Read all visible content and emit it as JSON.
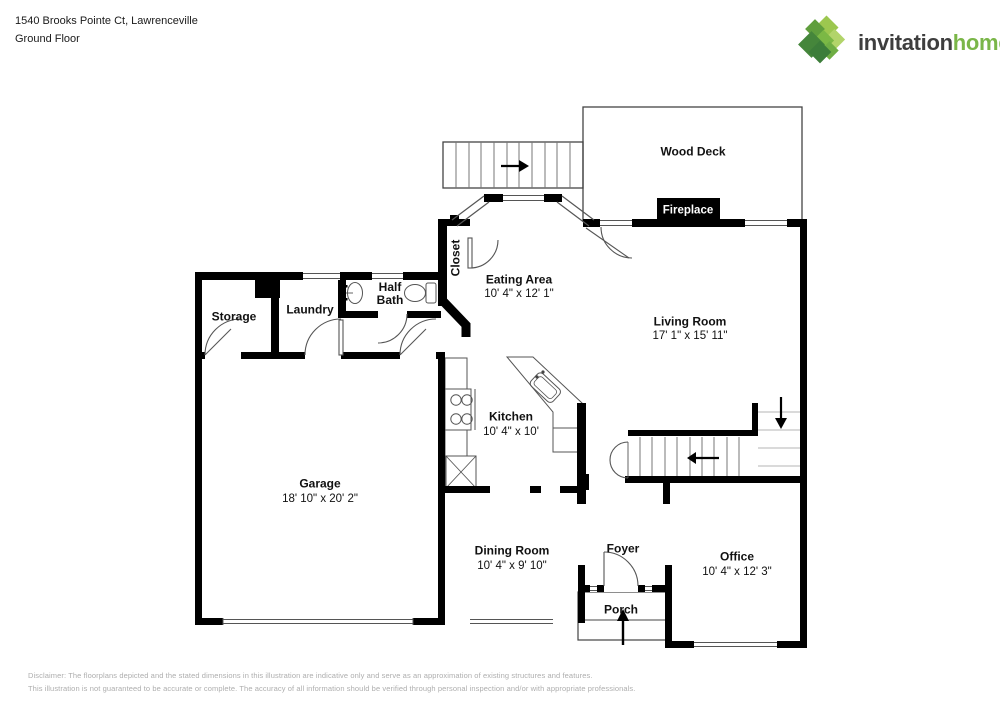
{
  "header": {
    "address_line": "1540 Brooks Pointe Ct, Lawrenceville",
    "floor_line": "Ground Floor"
  },
  "logo": {
    "word_primary": "invitation",
    "word_secondary": "homes",
    "trademark": "™",
    "color_primary_text": "#3e3e3e",
    "color_secondary_text": "#7ab648",
    "mark_colors": [
      "#9cc74f",
      "#b2d46a",
      "#5f9e3d",
      "#7bb845",
      "#6fae44",
      "#45863b",
      "#3c7d3a"
    ]
  },
  "floorplan": {
    "rooms": {
      "wood_deck": {
        "name": "Wood Deck"
      },
      "fireplace": {
        "name": "Fireplace"
      },
      "closet": {
        "name": "Closet"
      },
      "eating_area": {
        "name": "Eating Area",
        "dims": "10' 4\" x 12' 1\""
      },
      "living_room": {
        "name": "Living Room",
        "dims": "17' 1\" x 15' 11\""
      },
      "half_bath": {
        "name": "Half\nBath"
      },
      "laundry": {
        "name": "Laundry"
      },
      "storage": {
        "name": "Storage"
      },
      "kitchen": {
        "name": "Kitchen",
        "dims": "10' 4\" x 10'"
      },
      "garage": {
        "name": "Garage",
        "dims": "18' 10\" x 20' 2\""
      },
      "dining_room": {
        "name": "Dining Room",
        "dims": "10' 4\" x 9' 10\""
      },
      "foyer": {
        "name": "Foyer"
      },
      "office": {
        "name": "Office",
        "dims": "10' 4\" x 12' 3\""
      },
      "porch": {
        "name": "Porch"
      }
    },
    "icons": {
      "exterior_stairs_arrow": "→",
      "interior_stairs_arrow": "←",
      "stairs_down_arrow": "↓",
      "porch_entry_arrow": "↑"
    },
    "wall_color": "#000000",
    "outline_color": "#444444"
  },
  "disclaimer": {
    "line1": "Disclaimer: The floorplans depicted and the stated dimensions in this illustration are indicative only and serve as an approximation of existing structures and features.",
    "line2": "This illustration is not guaranteed to be accurate or complete. The accuracy of all information should be verified through personal inspection and/or with appropriate professionals."
  }
}
